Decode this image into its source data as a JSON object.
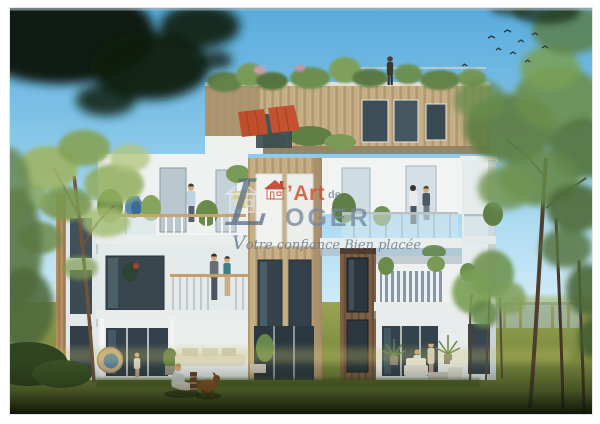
{
  "photo": {
    "kind": "architectural-rendering-scan",
    "border_color": "#ffffff"
  },
  "watermark": {
    "logo_initial": "L",
    "logo_art": "’Art",
    "logo_de": "de",
    "logo_rest": "OGER",
    "logo_full": "L’Art de LOGER",
    "tagline": "Votre confiance Bien placée",
    "colors": {
      "accent_red": "#c4402a",
      "art_orange_red": "#d0502e",
      "logo_slate_blue": "#6e8196",
      "tagline_slate": "#64788e"
    }
  },
  "scene": {
    "sky": {
      "top": "#58abdb",
      "horizon": "#d9effa"
    },
    "grass": {
      "light": "#9aa554",
      "dark": "#5d6e30",
      "foreground_shadow": "#16200c"
    },
    "building": {
      "facade_white": "#f3f5f4",
      "penthouse_wood": "#c6ae85",
      "dark_wood": "#7e6046",
      "glass": "#33424c",
      "awning_orange": "#bf4e2c"
    },
    "foliage": {
      "bright": "#9db565",
      "deep": "#4c6a38",
      "silhouette": "#0b150d"
    },
    "figures": [
      "person-on-roof",
      "man-on-top-terrace",
      "couple-on-third-floor-balcony",
      "couple-on-second-floor-balcony",
      "child-on-ground-terrace",
      "people-on-ground-terrace",
      "woman-on-lawn",
      "dog-on-lawn"
    ],
    "birds_count": 9
  }
}
